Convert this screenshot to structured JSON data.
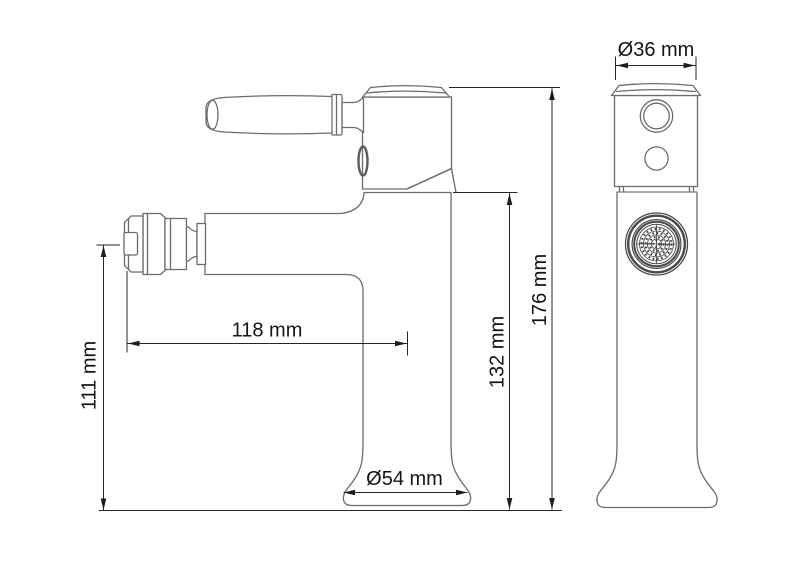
{
  "drawing": {
    "background_color": "#ffffff",
    "outline_color": "#6b6b6b",
    "dimension_color": "#1d1d1d",
    "dimensions": {
      "spout_height": "111 mm",
      "spout_reach": "118 mm",
      "body_height": "132 mm",
      "total_height": "176 mm",
      "base_diameter": "Ø54 mm",
      "top_diameter": "Ø36 mm"
    }
  }
}
